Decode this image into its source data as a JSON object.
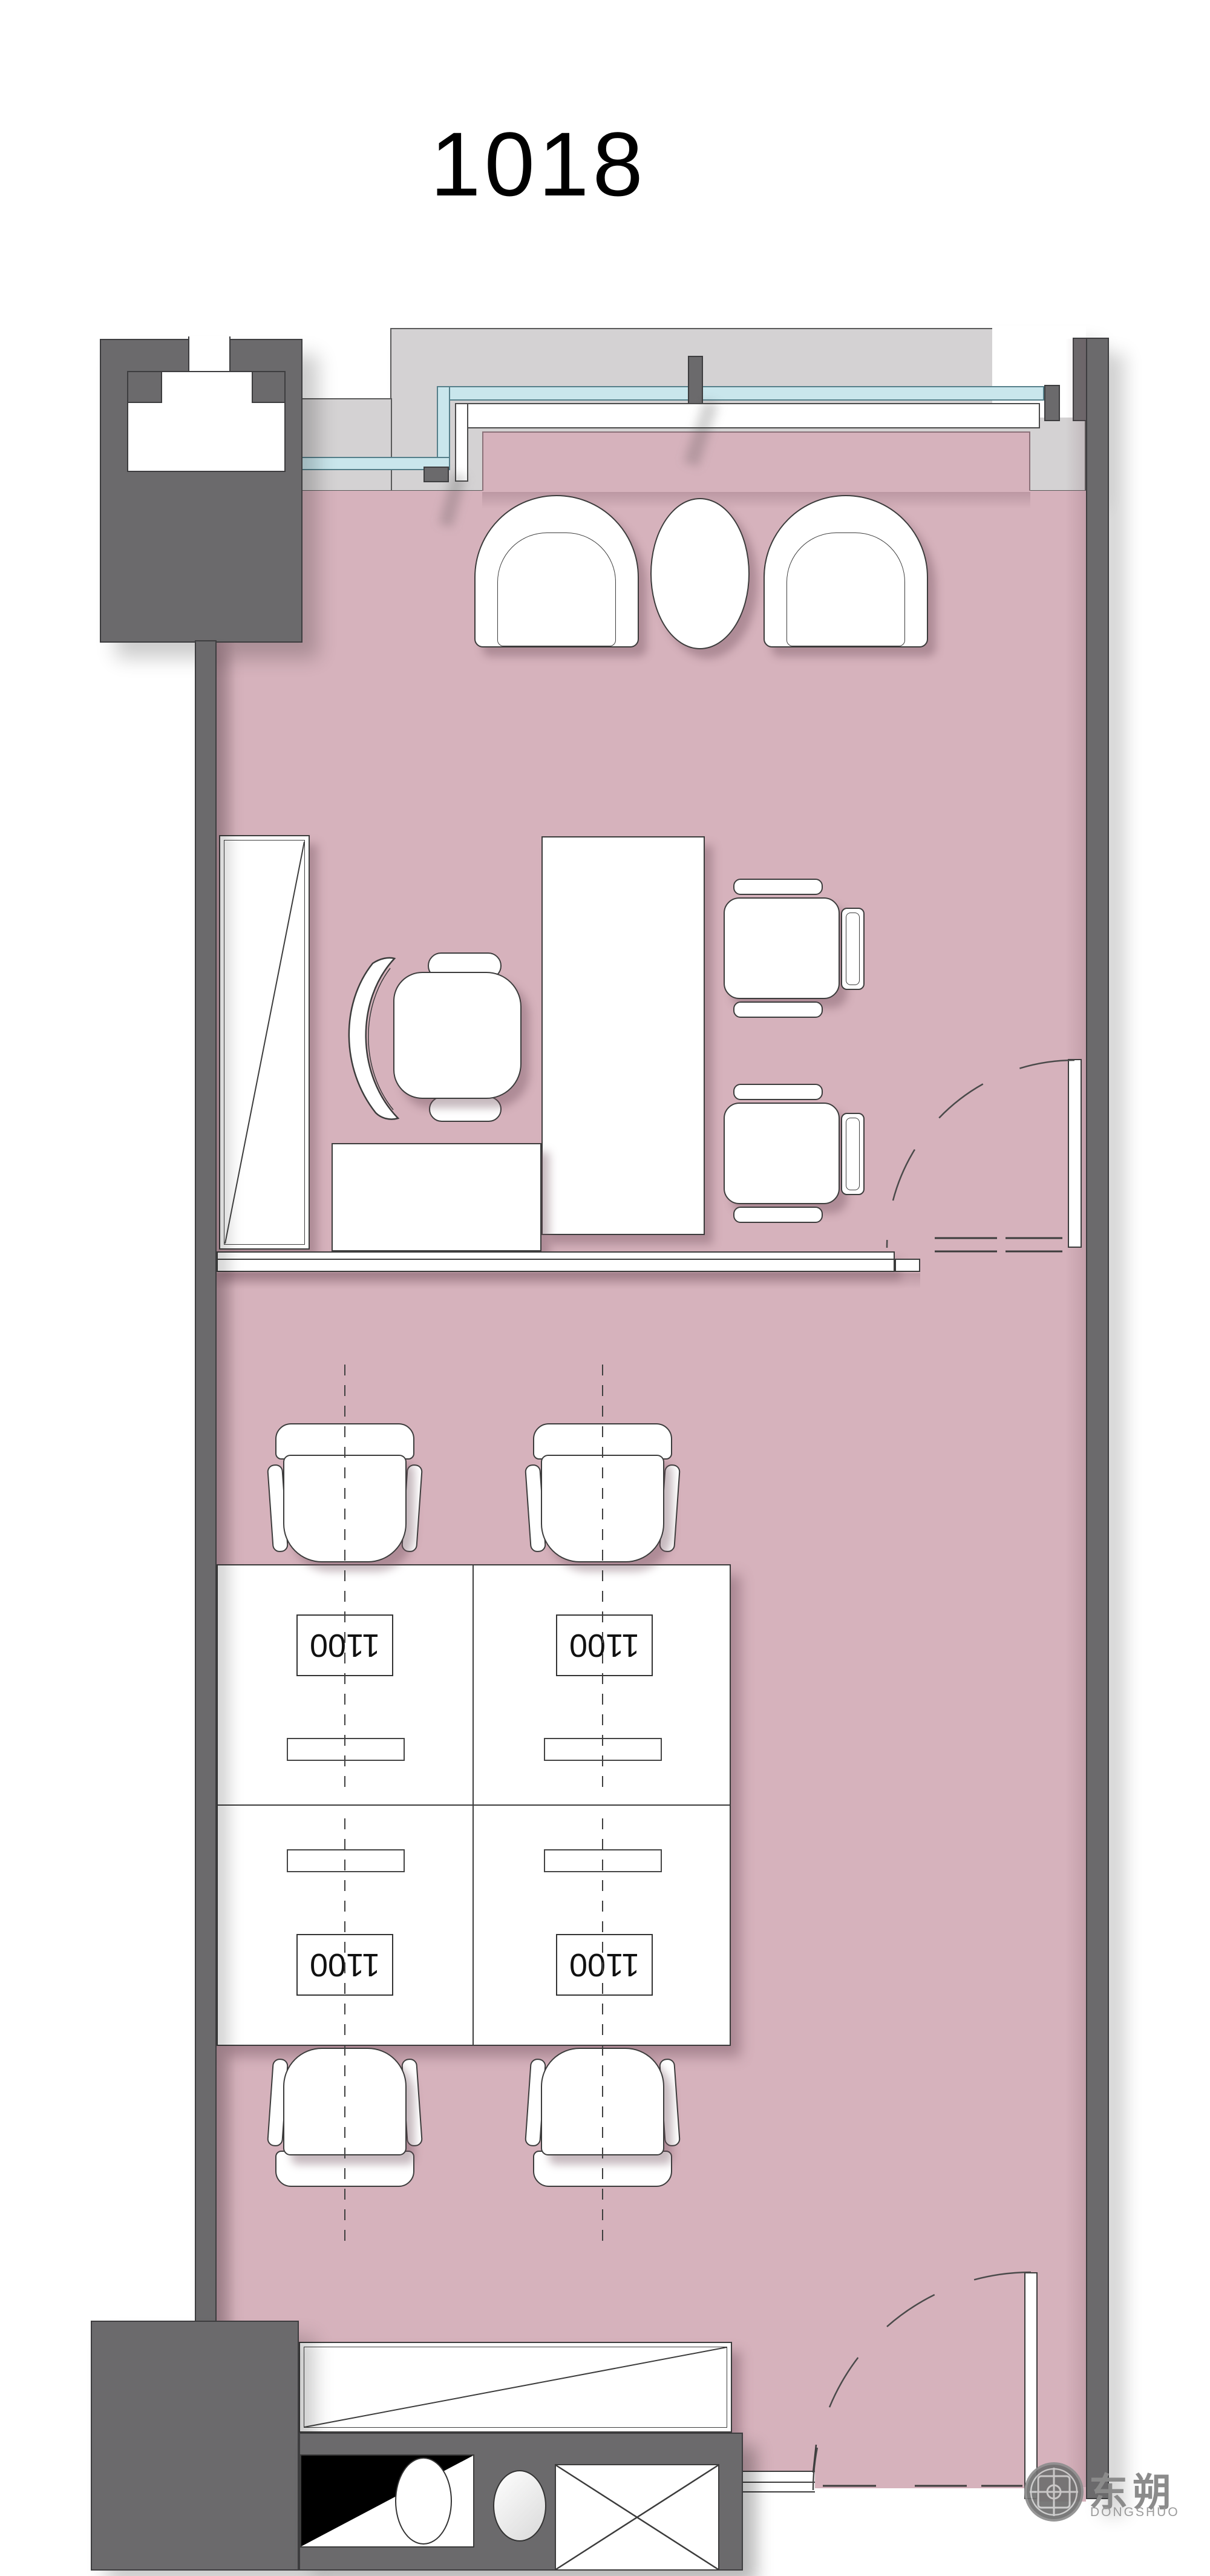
{
  "title": "1018",
  "watermark": {
    "logo_text": "东朔",
    "logo_subtext": "DONGSHUO"
  },
  "floor_plan": {
    "room_number": "1018",
    "workstation_labels": [
      "1100",
      "1100",
      "1100",
      "1100"
    ],
    "furniture": [
      "lounge-armchair x2",
      "round-side-table",
      "tall-cabinet",
      "executive-desk",
      "desk-return",
      "executive-chair",
      "guest-chair x2",
      "low-credenza",
      "swing-door x2",
      "workstation-desk x4",
      "task-chair x4",
      "pantry-counter",
      "sink-unit",
      "basin",
      "vent-shaft",
      "threshold"
    ],
    "colors": {
      "floor": "#d6b2bc",
      "wall": "#6b6a6c",
      "balcony_slab": "#d4d2d3",
      "glazing": "#c9e6ec",
      "furniture": "#ffffff",
      "linework": "#3c3c3c",
      "watermark": "#8b8b8b"
    }
  }
}
